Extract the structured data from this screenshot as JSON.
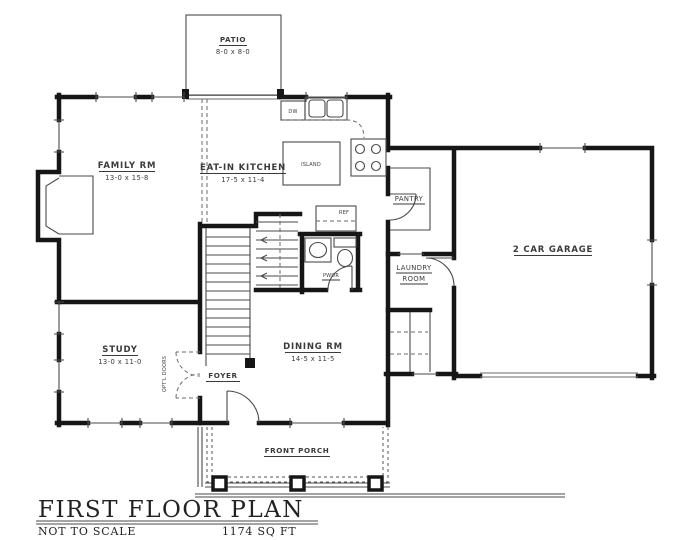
{
  "title_block": {
    "title": "FIRST FLOOR PLAN",
    "scale_note": "NOT TO SCALE",
    "area": "1174 SQ FT"
  },
  "rooms": [
    {
      "id": "patio",
      "name": "PATIO",
      "dims": "8-0 x 8-0"
    },
    {
      "id": "family",
      "name": "FAMILY RM",
      "dims": "13-0 x 15-8"
    },
    {
      "id": "kitchen",
      "name": "EAT-IN KITCHEN",
      "dims": "17-5 x 11-4"
    },
    {
      "id": "island",
      "name": "ISLAND"
    },
    {
      "id": "pantry",
      "name": "PANTRY"
    },
    {
      "id": "garage",
      "name": "2 CAR GARAGE"
    },
    {
      "id": "laundry",
      "name": "LAUNDRY",
      "name2": "ROOM"
    },
    {
      "id": "powder",
      "name": "PWDR"
    },
    {
      "id": "dining",
      "name": "DINING RM",
      "dims": "14-5 x 11-5"
    },
    {
      "id": "study",
      "name": "STUDY",
      "dims": "13-0 x 11-0"
    },
    {
      "id": "foyer",
      "name": "FOYER"
    },
    {
      "id": "porch",
      "name": "FRONT PORCH"
    }
  ],
  "annotations": {
    "optional_doors": "OPT'L DOORS",
    "dishwasher": "DW",
    "refrigerator": "REF"
  },
  "colors": {
    "wall": "#161616",
    "thin_line": "#4a4a4a",
    "label": "#3a3a3a",
    "background": "#ffffff"
  }
}
